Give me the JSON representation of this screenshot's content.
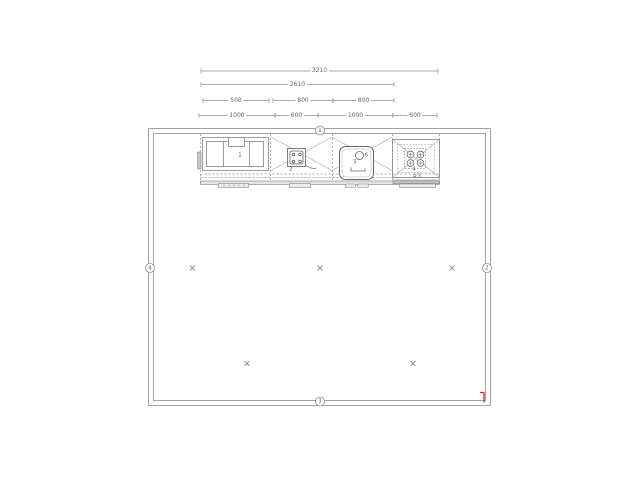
{
  "drawing": {
    "type": "kitchen-floor-plan",
    "colors": {
      "line": "#8f8f8f",
      "line_dark": "#666666",
      "text": "#666666",
      "accent_red": "#cc2222"
    },
    "dimension_rows": [
      {
        "y": 71,
        "segments": [
          {
            "label": "3210",
            "x1": 201,
            "x2": 438
          }
        ]
      },
      {
        "y": 84.5,
        "segments": [
          {
            "label": "2610",
            "x1": 201,
            "x2": 394
          }
        ]
      },
      {
        "y": 100.5,
        "segments": [
          {
            "label": "500",
            "x1": 203,
            "x2": 269
          },
          {
            "label": "800",
            "x1": 273,
            "x2": 333
          },
          {
            "label": "800",
            "x1": 333,
            "x2": 394
          }
        ]
      },
      {
        "y": 115.5,
        "segments": [
          {
            "label": "1000",
            "x1": 199,
            "x2": 275
          },
          {
            "label": "600",
            "x1": 275,
            "x2": 318
          },
          {
            "label": "1000",
            "x1": 318,
            "x2": 393
          },
          {
            "label": "600",
            "x1": 393,
            "x2": 437
          }
        ]
      }
    ],
    "room": {
      "outer": {
        "x": 148.5,
        "y": 128.5,
        "w": 342,
        "h": 277
      },
      "inner": {
        "x": 153.5,
        "y": 133.5,
        "w": 332,
        "h": 267
      }
    },
    "wall_markers": [
      {
        "label": "1",
        "x": 320,
        "y": 130.5
      },
      {
        "label": "2",
        "x": 487,
        "y": 268
      },
      {
        "label": "3",
        "x": 320,
        "y": 401.5
      },
      {
        "label": "4",
        "x": 150,
        "y": 268
      }
    ],
    "floor_crosses": [
      {
        "x": 192.5,
        "y": 268
      },
      {
        "x": 320,
        "y": 268
      },
      {
        "x": 452,
        "y": 268
      },
      {
        "x": 247,
        "y": 363.5
      },
      {
        "x": 413,
        "y": 363.5
      }
    ],
    "item_labels": [
      {
        "label": "1",
        "x": 240,
        "y": 156
      },
      {
        "label": "2",
        "x": 291,
        "y": 170
      },
      {
        "label": "5",
        "x": 355,
        "y": 163
      },
      {
        "label": "6",
        "x": 366.5,
        "y": 156
      },
      {
        "label": "4",
        "x": 414,
        "y": 170
      },
      {
        "label": "4.3",
        "x": 417,
        "y": 176.5
      }
    ],
    "origin_marker": {
      "x": 484,
      "y": 392.5,
      "height": 10,
      "tick": 4,
      "color": "#cc2222"
    }
  }
}
